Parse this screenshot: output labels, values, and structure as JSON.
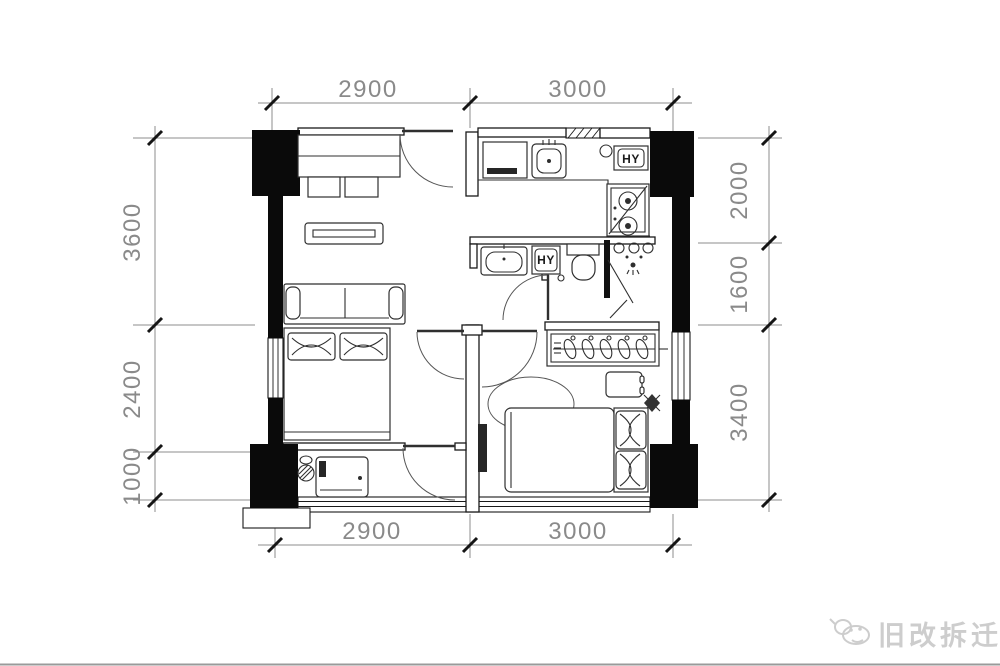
{
  "meta": {
    "kind": "apartment floor plan drawing"
  },
  "dims": {
    "top": [
      "2900",
      "3000"
    ],
    "bottom": [
      "2900",
      "3000"
    ],
    "left": [
      "3600",
      "2400",
      "1000"
    ],
    "right": [
      "2000",
      "1600",
      "3400"
    ]
  },
  "fixtures": {
    "water_heater_label": "HY",
    "washer_label": "HY"
  },
  "watermark": {
    "text": "旧改拆迁"
  },
  "colors": {
    "walls": "#0a0a0a",
    "furniture_line": "#2f2f2f",
    "dimension_line": "#8c8c8c",
    "dimension_text": "#8a8a8a",
    "watermark": "#cdcdcd",
    "background": "#ffffff"
  }
}
